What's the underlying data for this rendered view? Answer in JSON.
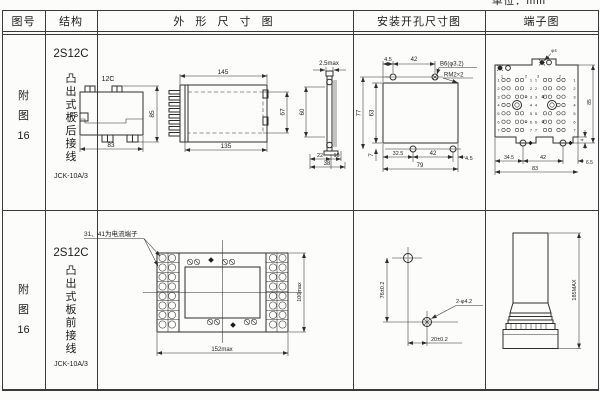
{
  "unit_label": "单位：mm",
  "headers": {
    "col1": "图号",
    "col2": "结构",
    "col3": "外 形 尺 寸 图",
    "col4": "安装开孔尺寸图",
    "col5": "端子图"
  },
  "rows": [
    {
      "fig": [
        "附",
        "图",
        "16"
      ],
      "model": "2S12C",
      "mount": [
        "凸",
        "出",
        "式",
        "板",
        "后",
        "接",
        "线"
      ],
      "code": "JCK-10A/3"
    },
    {
      "fig": [
        "附",
        "图",
        "16"
      ],
      "model": "2S12C",
      "mount": [
        "凸",
        "出",
        "式",
        "板",
        "前",
        "接",
        "线"
      ],
      "code": "JCK-10A/3"
    }
  ],
  "front_view": {
    "top": "12C",
    "left": "2S",
    "width": "83",
    "height": "85"
  },
  "side_view": {
    "top": "145",
    "bottom": "135",
    "right": "67"
  },
  "section_view": {
    "top": "2.5max",
    "left": "60",
    "b1": "22",
    "b2": "10",
    "total": "38"
  },
  "install1": {
    "t1": "4.5",
    "t2": "42",
    "c1": "B6(φ3.2)",
    "c2": "RM2×2",
    "l1": "77",
    "l2": "63",
    "l3": "7",
    "b1": "32.5",
    "b2": "42",
    "b3": "4.5",
    "total": "79"
  },
  "terminal1": {
    "screw": "φ4",
    "tops": [
      "1",
      "2",
      "3",
      "2"
    ],
    "rows": [
      "1",
      "2",
      "3",
      "4",
      "5",
      "6",
      "7"
    ],
    "b1": "34.5",
    "b2": "42",
    "b3": "6.5",
    "total": "83",
    "right": "85",
    "step": "4"
  },
  "wiring": {
    "note": "31、41为电流端子",
    "width": "152max",
    "height": "100max"
  },
  "install2": {
    "v": "76±0.2",
    "h": "20±0.2",
    "callout": "2-φ4.2"
  },
  "profile": {
    "height": "185MAX"
  }
}
